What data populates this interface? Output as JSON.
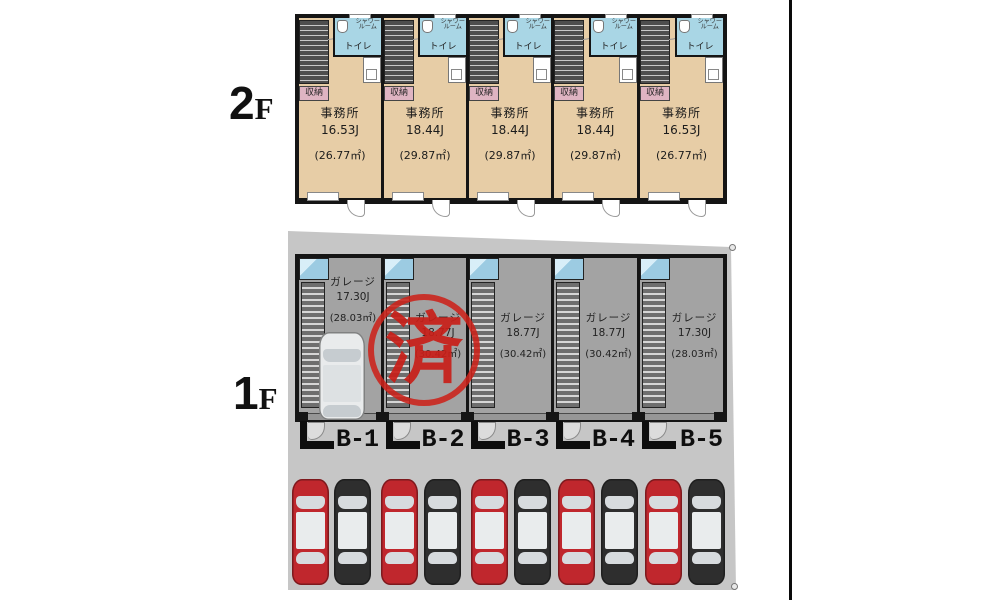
{
  "colors": {
    "floor2_room": "#e7cda6",
    "wet_area": "#a9d6e5",
    "garage_floor": "#a3a3a3",
    "site": "#c6c6c6",
    "wall": "#151515",
    "stamp_red": "#cc221a",
    "car_red": "#c0272d",
    "car_black": "#2e2e2e",
    "car_white": "#e9ebec"
  },
  "floor2": {
    "floor_label": {
      "num": "2",
      "suffix": "F"
    },
    "room_labels": {
      "shower_line1": "シャワー",
      "shower_line2": "ルーム",
      "toilet": "トイレ",
      "storage": "収納"
    },
    "units": [
      {
        "name": "事務所",
        "size": "16.53J",
        "area": "(26.77㎡)"
      },
      {
        "name": "事務所",
        "size": "18.44J",
        "area": "(29.87㎡)"
      },
      {
        "name": "事務所",
        "size": "18.44J",
        "area": "(29.87㎡)"
      },
      {
        "name": "事務所",
        "size": "18.44J",
        "area": "(29.87㎡)"
      },
      {
        "name": "事務所",
        "size": "16.53J",
        "area": "(26.77㎡)"
      }
    ]
  },
  "floor1": {
    "floor_label": {
      "num": "1",
      "suffix": "F"
    },
    "units": [
      {
        "name": "ガレージ",
        "size": "17.30J",
        "area": "(28.03㎡)",
        "bay": "B-1"
      },
      {
        "name": "ガレージ",
        "size": "18.77J",
        "area": "(30.42㎡)",
        "bay": "B-2",
        "stamp": "済"
      },
      {
        "name": "ガレージ",
        "size": "18.77J",
        "area": "(30.42㎡)",
        "bay": "B-3"
      },
      {
        "name": "ガレージ",
        "size": "18.77J",
        "area": "(30.42㎡)",
        "bay": "B-4"
      },
      {
        "name": "ガレージ",
        "size": "17.30J",
        "area": "(28.03㎡)",
        "bay": "B-5"
      }
    ]
  },
  "parking": {
    "cars": [
      "red",
      "black",
      "red",
      "black",
      "red",
      "black",
      "red",
      "black",
      "red",
      "black"
    ]
  }
}
